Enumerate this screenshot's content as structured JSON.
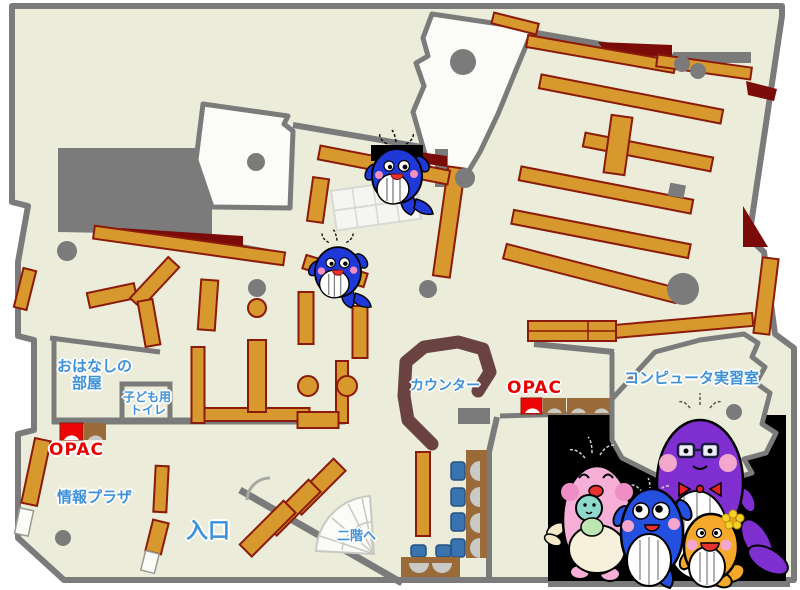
{
  "page": {
    "type": "library-floor-map"
  },
  "labels": {
    "storytelling_room_line1": "おはなしの",
    "storytelling_room_line2": "部屋",
    "kids_toilet_line1": "子ども用",
    "kids_toilet_line2": "トイレ",
    "opac_left": "OPAC",
    "opac_right": "OPAC",
    "info_plaza": "情報プラザ",
    "entrance": "入口",
    "counter": "カウンター",
    "computer_room": "コンピュータ実習室",
    "to_second_floor": "二階へ"
  },
  "colors": {
    "floor": "#ECECDB",
    "wall": "#7B7B7B",
    "shelf": "#D7992E",
    "shelf_border": "#8B1A08",
    "label_blue": "#3E91D8",
    "opac_red": "#E60000",
    "counter_brown": "#6B4242",
    "dark_red": "#7A0B08",
    "chair_blue": "#3A74B0",
    "table_brown": "#9A6A38",
    "mascot_background": "#000000",
    "mascot_blue": "#1F39D8",
    "mascot_pink": "#F6AFD7",
    "mascot_purple": "#7F2FD0",
    "mascot_orange": "#F5A829"
  }
}
